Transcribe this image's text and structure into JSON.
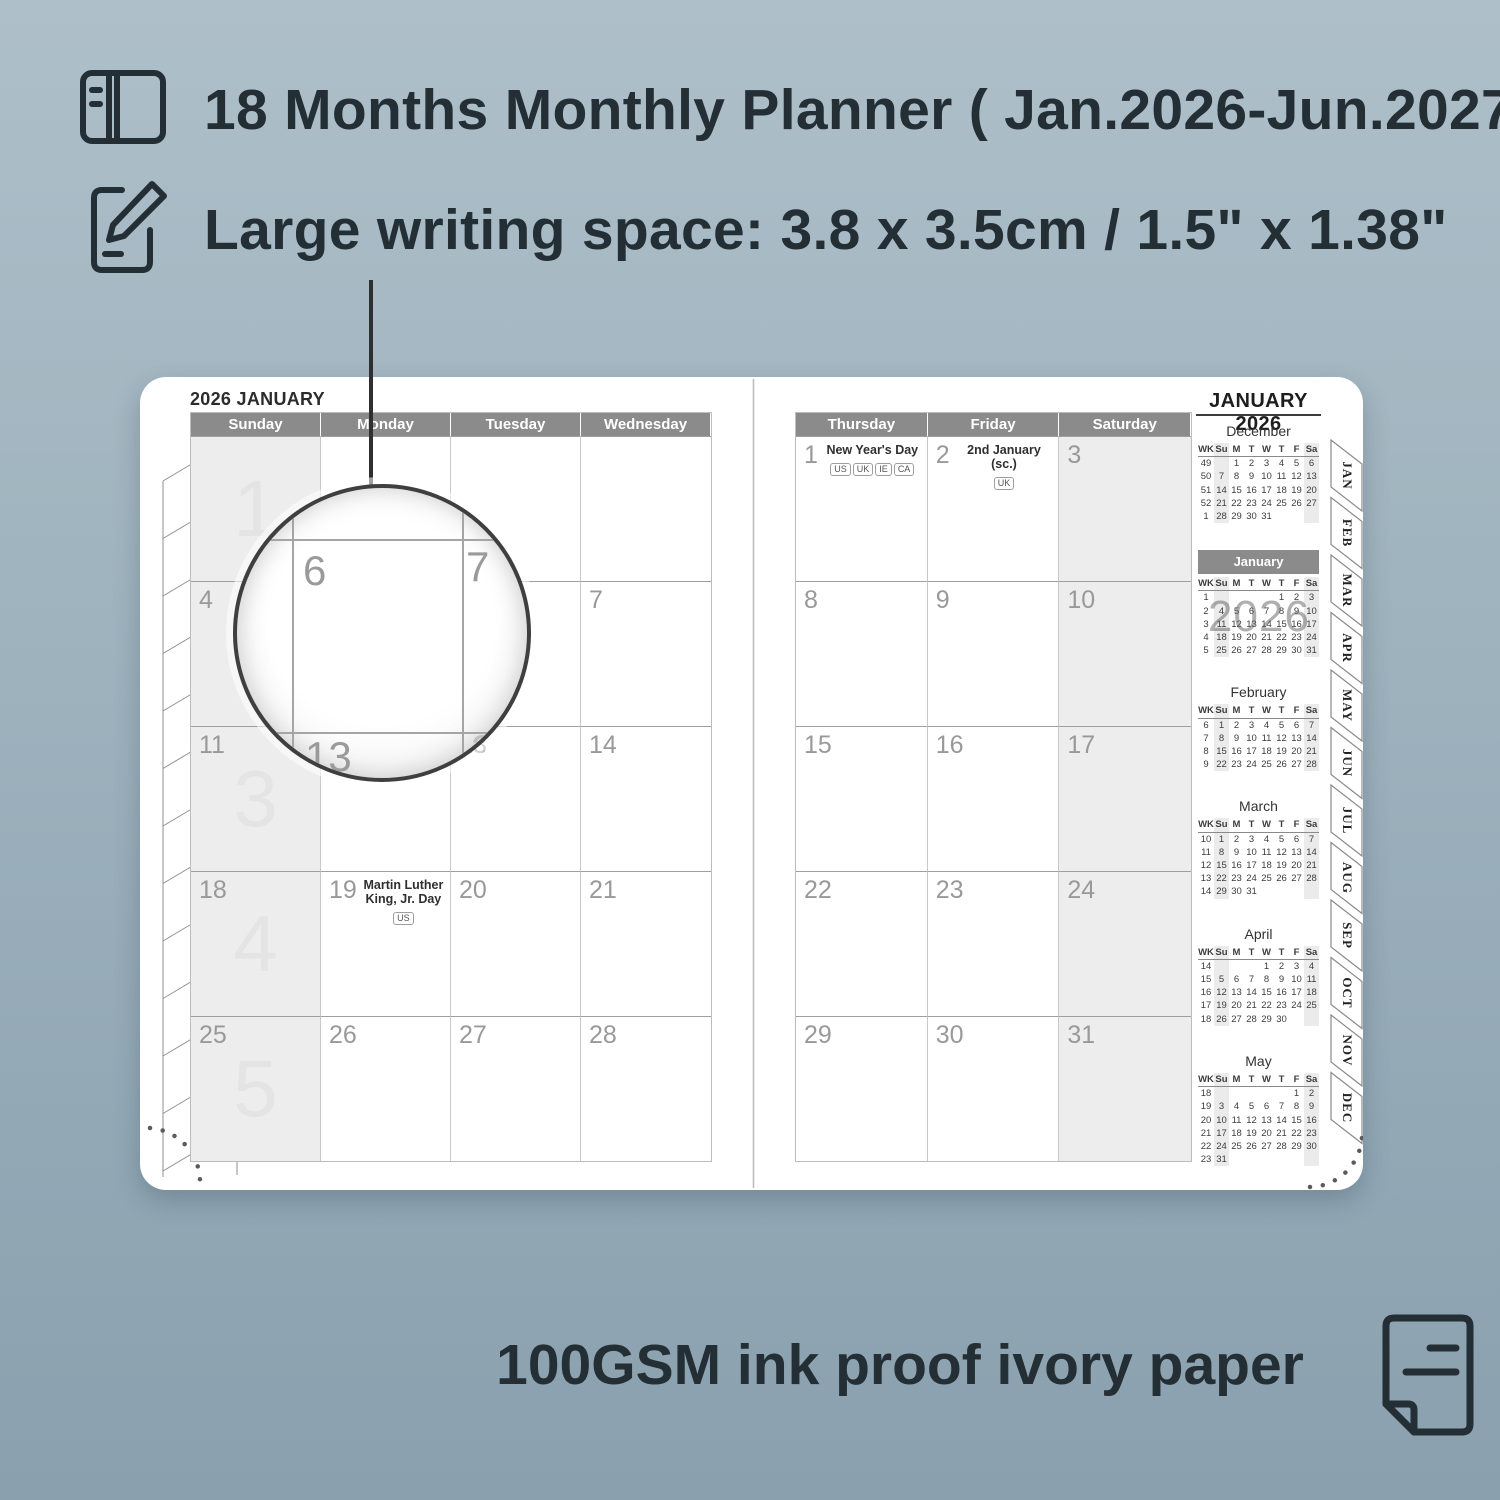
{
  "colors": {
    "background_top": "#aebfc9",
    "background_bottom": "#8aa0ae",
    "ink": "#232e35",
    "header_gray": "#8b8b8b",
    "column_shade": "#ededed",
    "date_gray": "#999999",
    "watermark_gray": "#e4e4e4"
  },
  "features": [
    {
      "icon": "planner-book-icon",
      "text": "18 Months Monthly Planner ( Jan.2026-Jun.2027)"
    },
    {
      "icon": "pencil-note-icon",
      "text": "Large writing space: 3.8 x 3.5cm / 1.5\" x 1.38\""
    }
  ],
  "footer": {
    "icon": "paper-icon",
    "text": "100GSM ink proof ivory paper"
  },
  "magnifier": {
    "labels": [
      {
        "text": "6",
        "x": 66,
        "y": 62,
        "muted": false
      },
      {
        "text": "7",
        "x": 229,
        "y": 58,
        "muted": false
      },
      {
        "text": "13",
        "x": 68,
        "y": 248,
        "muted": false
      },
      {
        "text": "3",
        "x": 234,
        "y": 241,
        "muted": true
      }
    ]
  },
  "left_page": {
    "title": "2026 JANUARY",
    "day_headers": [
      "Sunday",
      "Monday",
      "Tuesday",
      "Wednesday"
    ],
    "weeks": [
      {
        "watermark": "1",
        "cells": [
          {
            "date": ""
          },
          {
            "date": ""
          },
          {
            "date": ""
          },
          {
            "date": ""
          }
        ]
      },
      {
        "watermark": "",
        "cells": [
          {
            "date": "4"
          },
          {
            "date": ""
          },
          {
            "date": ""
          },
          {
            "date": "7"
          }
        ]
      },
      {
        "watermark": "3",
        "cells": [
          {
            "date": "11"
          },
          {
            "date": ""
          },
          {
            "date": "13"
          },
          {
            "date": "14"
          }
        ]
      },
      {
        "watermark": "4",
        "cells": [
          {
            "date": "18"
          },
          {
            "date": "19",
            "holiday": "Martin Luther King, Jr. Day",
            "badges": [
              "US"
            ]
          },
          {
            "date": "20"
          },
          {
            "date": "21"
          }
        ]
      },
      {
        "watermark": "5",
        "cells": [
          {
            "date": "25"
          },
          {
            "date": "26"
          },
          {
            "date": "27"
          },
          {
            "date": "28"
          }
        ]
      }
    ]
  },
  "right_page": {
    "title": "JANUARY 2026",
    "day_headers": [
      "Thursday",
      "Friday",
      "Saturday"
    ],
    "weeks": [
      {
        "watermark": "",
        "cells": [
          {
            "date": "1",
            "holiday": "New Year's Day",
            "badges": [
              "US",
              "UK",
              "IE",
              "CA"
            ]
          },
          {
            "date": "2",
            "holiday": "2nd January (sc.)",
            "badges": [
              "UK"
            ]
          },
          {
            "date": "3"
          }
        ]
      },
      {
        "watermark": "",
        "cells": [
          {
            "date": "8"
          },
          {
            "date": "9"
          },
          {
            "date": "10"
          }
        ]
      },
      {
        "watermark": "",
        "cells": [
          {
            "date": "15"
          },
          {
            "date": "16"
          },
          {
            "date": "17"
          }
        ]
      },
      {
        "watermark": "",
        "cells": [
          {
            "date": "22"
          },
          {
            "date": "23"
          },
          {
            "date": "24"
          }
        ]
      },
      {
        "watermark": "",
        "cells": [
          {
            "date": "29"
          },
          {
            "date": "30"
          },
          {
            "date": "31"
          }
        ]
      }
    ]
  },
  "mini_calendars": {
    "header": [
      "WK",
      "Su",
      "M",
      "T",
      "W",
      "T",
      "F",
      "Sa"
    ],
    "watermark": "2026",
    "months": [
      {
        "name": "December",
        "highlight": false,
        "rows": [
          {
            "wk": "49",
            "days": [
              "",
              "1",
              "2",
              "3",
              "4",
              "5",
              "6"
            ]
          },
          {
            "wk": "50",
            "days": [
              "7",
              "8",
              "9",
              "10",
              "11",
              "12",
              "13"
            ]
          },
          {
            "wk": "51",
            "days": [
              "14",
              "15",
              "16",
              "17",
              "18",
              "19",
              "20"
            ]
          },
          {
            "wk": "52",
            "days": [
              "21",
              "22",
              "23",
              "24",
              "25",
              "26",
              "27"
            ]
          },
          {
            "wk": "1",
            "days": [
              "28",
              "29",
              "30",
              "31",
              "",
              "",
              ""
            ]
          }
        ]
      },
      {
        "name": "January",
        "highlight": true,
        "rows": [
          {
            "wk": "1",
            "days": [
              "",
              "",
              "",
              "",
              "1",
              "2",
              "3"
            ]
          },
          {
            "wk": "2",
            "days": [
              "4",
              "5",
              "6",
              "7",
              "8",
              "9",
              "10"
            ]
          },
          {
            "wk": "3",
            "days": [
              "11",
              "12",
              "13",
              "14",
              "15",
              "16",
              "17"
            ]
          },
          {
            "wk": "4",
            "days": [
              "18",
              "19",
              "20",
              "21",
              "22",
              "23",
              "24"
            ]
          },
          {
            "wk": "5",
            "days": [
              "25",
              "26",
              "27",
              "28",
              "29",
              "30",
              "31"
            ]
          }
        ]
      },
      {
        "name": "February",
        "highlight": false,
        "rows": [
          {
            "wk": "6",
            "days": [
              "1",
              "2",
              "3",
              "4",
              "5",
              "6",
              "7"
            ]
          },
          {
            "wk": "7",
            "days": [
              "8",
              "9",
              "10",
              "11",
              "12",
              "13",
              "14"
            ]
          },
          {
            "wk": "8",
            "days": [
              "15",
              "16",
              "17",
              "18",
              "19",
              "20",
              "21"
            ]
          },
          {
            "wk": "9",
            "days": [
              "22",
              "23",
              "24",
              "25",
              "26",
              "27",
              "28"
            ]
          }
        ]
      },
      {
        "name": "March",
        "highlight": false,
        "rows": [
          {
            "wk": "10",
            "days": [
              "1",
              "2",
              "3",
              "4",
              "5",
              "6",
              "7"
            ]
          },
          {
            "wk": "11",
            "days": [
              "8",
              "9",
              "10",
              "11",
              "12",
              "13",
              "14"
            ]
          },
          {
            "wk": "12",
            "days": [
              "15",
              "16",
              "17",
              "18",
              "19",
              "20",
              "21"
            ]
          },
          {
            "wk": "13",
            "days": [
              "22",
              "23",
              "24",
              "25",
              "26",
              "27",
              "28"
            ]
          },
          {
            "wk": "14",
            "days": [
              "29",
              "30",
              "31",
              "",
              "",
              "",
              ""
            ]
          }
        ]
      },
      {
        "name": "April",
        "highlight": false,
        "rows": [
          {
            "wk": "14",
            "days": [
              "",
              "",
              "",
              "1",
              "2",
              "3",
              "4"
            ]
          },
          {
            "wk": "15",
            "days": [
              "5",
              "6",
              "7",
              "8",
              "9",
              "10",
              "11"
            ]
          },
          {
            "wk": "16",
            "days": [
              "12",
              "13",
              "14",
              "15",
              "16",
              "17",
              "18"
            ]
          },
          {
            "wk": "17",
            "days": [
              "19",
              "20",
              "21",
              "22",
              "23",
              "24",
              "25"
            ]
          },
          {
            "wk": "18",
            "days": [
              "26",
              "27",
              "28",
              "29",
              "30",
              "",
              ""
            ]
          }
        ]
      },
      {
        "name": "May",
        "highlight": false,
        "rows": [
          {
            "wk": "18",
            "days": [
              "",
              "",
              "",
              "",
              "",
              "1",
              "2"
            ]
          },
          {
            "wk": "19",
            "days": [
              "3",
              "4",
              "5",
              "6",
              "7",
              "8",
              "9"
            ]
          },
          {
            "wk": "20",
            "days": [
              "10",
              "11",
              "12",
              "13",
              "14",
              "15",
              "16"
            ]
          },
          {
            "wk": "21",
            "days": [
              "17",
              "18",
              "19",
              "20",
              "21",
              "22",
              "23"
            ]
          },
          {
            "wk": "22",
            "days": [
              "24",
              "25",
              "26",
              "27",
              "28",
              "29",
              "30"
            ]
          },
          {
            "wk": "23",
            "days": [
              "31",
              "",
              "",
              "",
              "",
              "",
              ""
            ]
          }
        ]
      }
    ]
  },
  "tabs": [
    "JAN",
    "FEB",
    "MAR",
    "APR",
    "MAY",
    "JUN",
    "JUL",
    "AUG",
    "SEP",
    "OCT",
    "NOV",
    "DEC"
  ]
}
